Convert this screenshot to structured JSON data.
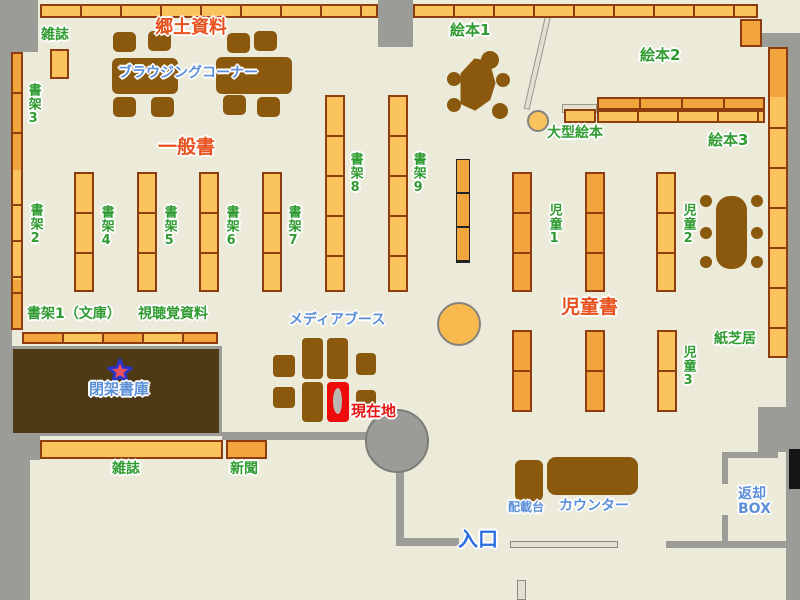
{
  "labels": {
    "local_materials": "郷土資料",
    "magazine_top": "雑誌",
    "shelf_3": "書架3",
    "shelf_2": "書架2",
    "browsing_corner": "ブラウジングコーナー",
    "general_books": "一般書",
    "shelf_4": "書架4",
    "shelf_5": "書架5",
    "shelf_6": "書架6",
    "shelf_7": "書架7",
    "shelf_8": "書架8",
    "shelf_9": "書架9",
    "picture_book_1": "絵本1",
    "picture_book_2": "絵本2",
    "picture_book_3": "絵本3",
    "large_picture_book": "大型絵本",
    "children_1": "児童1",
    "children_2": "児童2",
    "children_3": "児童3",
    "children_books": "児童書",
    "kamishibai": "紙芝居",
    "shelf_1_bunko": "書架1（文庫）",
    "audiovisual": "視聴覚資料",
    "media_booth": "メディアブース",
    "closed_stacks": "閉架書庫",
    "current_location": "現在地",
    "magazine_bottom": "雑誌",
    "newspaper": "新聞",
    "distribution_table": "配載台",
    "counter": "カウンター",
    "return_box_line1": "返却",
    "return_box_line2": "BOX",
    "entrance": "入口"
  },
  "icons": {
    "current_location_star": "star-icon"
  },
  "colors": {
    "floor": "#ecebda",
    "wall": "#9b9b97",
    "shelf_light": "#fbc35e",
    "shelf_dark": "#f2a53c",
    "shelf_border": "#8e3d0f",
    "furniture_brown": "#8a590e",
    "closed_stacks_fill": "#4e3a15",
    "label_red": "#e8501d",
    "label_green": "#2f9b30",
    "label_blue": "#5b8fd8",
    "current_location_red": "#e81313",
    "entrance_blue": "#2b6de0",
    "highlight_booth_red": "#ee0b0b",
    "return_slot_black": "#151515"
  }
}
